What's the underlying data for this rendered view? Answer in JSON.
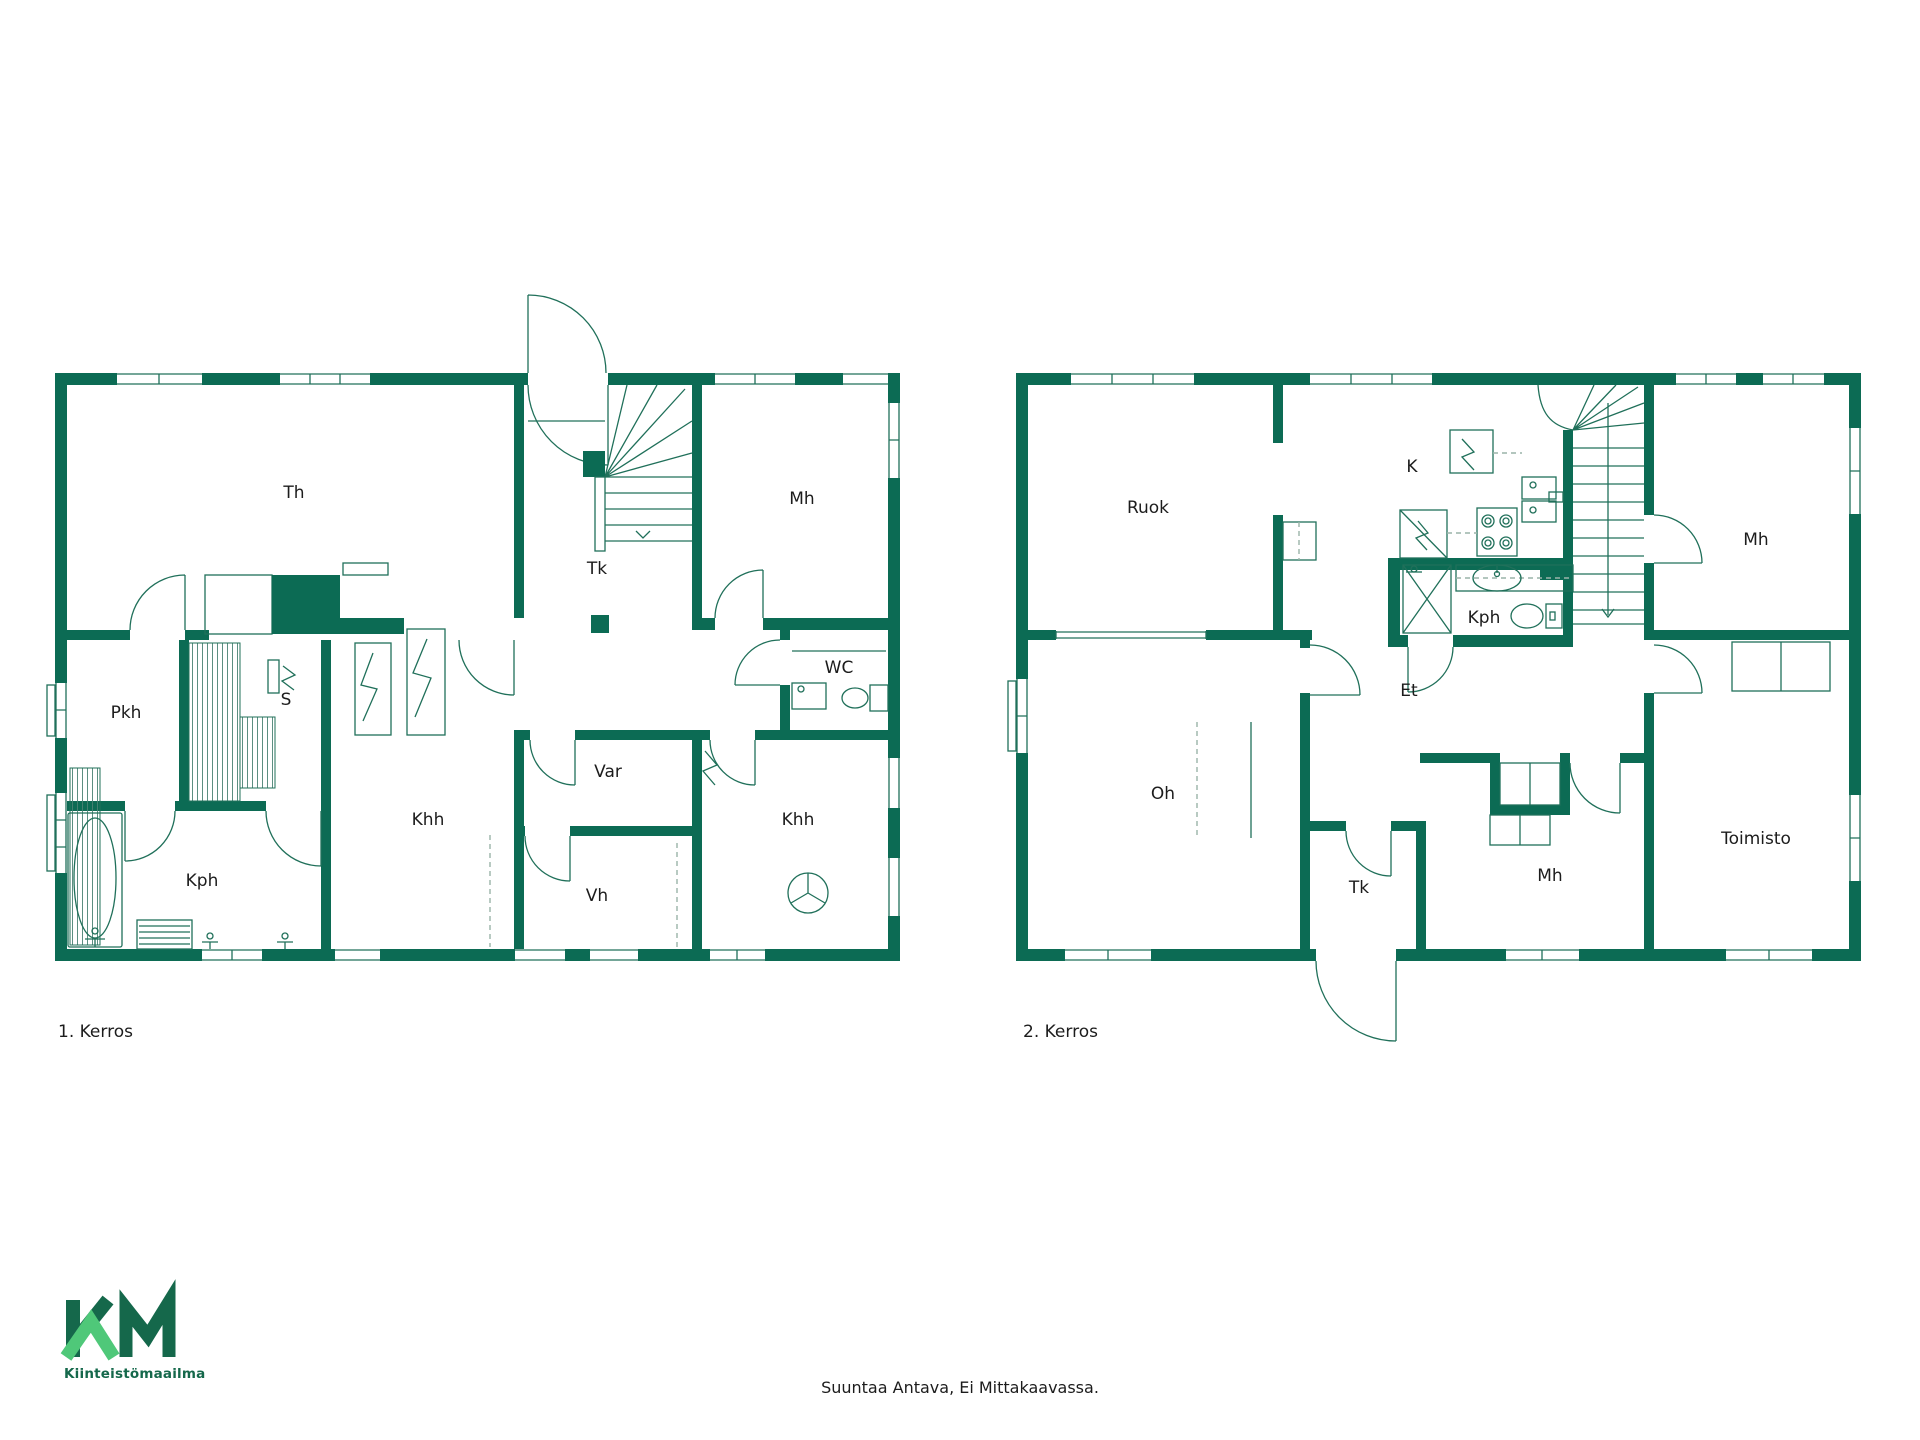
{
  "colors": {
    "wall": "#0c6b54",
    "line": "#20705a",
    "dash": "#9ab3a9",
    "text": "#1c1c1c",
    "logo_dark": "#15684b",
    "logo_light": "#4fc879",
    "background": "#ffffff"
  },
  "floor1": {
    "caption": "1. Kerros",
    "rooms": {
      "th": "Th",
      "tk": "Tk",
      "mh": "Mh",
      "wc": "WC",
      "khh_right": "Khh",
      "var": "Var",
      "vh": "Vh",
      "khh": "Khh",
      "pkh": "Pkh",
      "s": "S",
      "kph": "Kph"
    }
  },
  "floor2": {
    "caption": "2. Kerros",
    "rooms": {
      "ruok": "Ruok",
      "k": "K",
      "mh_top": "Mh",
      "kph": "Kph",
      "et": "Et",
      "oh": "Oh",
      "tk": "Tk",
      "mh": "Mh",
      "toimisto": "Toimisto"
    }
  },
  "logo": {
    "text": "Kiinteistömaailma"
  },
  "footer": {
    "note": "Suuntaa Antava, Ei Mittakaavassa."
  }
}
